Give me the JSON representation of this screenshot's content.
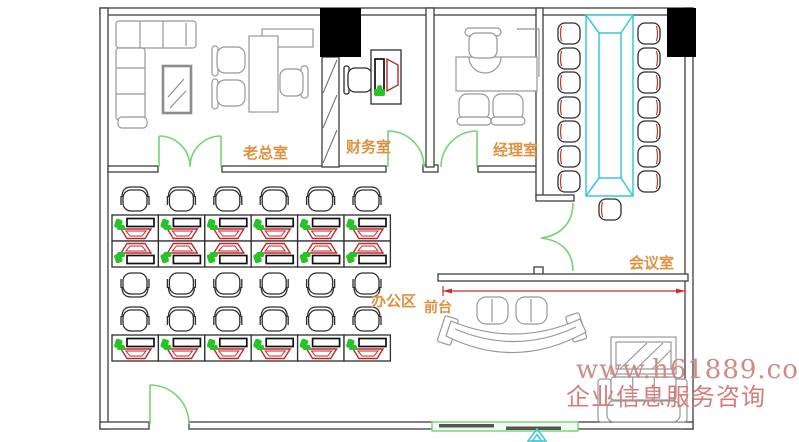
{
  "floor_plan": {
    "rooms": {
      "boss": "老总室",
      "finance": "财务室",
      "manager": "经理室",
      "meeting": "会议室",
      "office_area": "办公区",
      "reception": "前台"
    },
    "watermark": {
      "line1": "www.h61889.com",
      "line2": "企业信息服务咨询"
    },
    "furniture_counts": {
      "workstations": 18,
      "office_chairs": 18,
      "meeting_chairs": 15,
      "meeting_tables": 1,
      "reception_stools": 2,
      "sofas": 2
    },
    "colors": {
      "wall": "#3f3f3f",
      "column": "#000000",
      "door_green": "#74d474",
      "table_cyan": "#38c9d8",
      "monitor_red": "#c0282e",
      "device_green": "#27c427",
      "label_orange": "#de9140",
      "watermark_pink": "#cf8a8a",
      "dimension_red": "#cf2a2a",
      "furniture_gray": "#989898"
    }
  }
}
